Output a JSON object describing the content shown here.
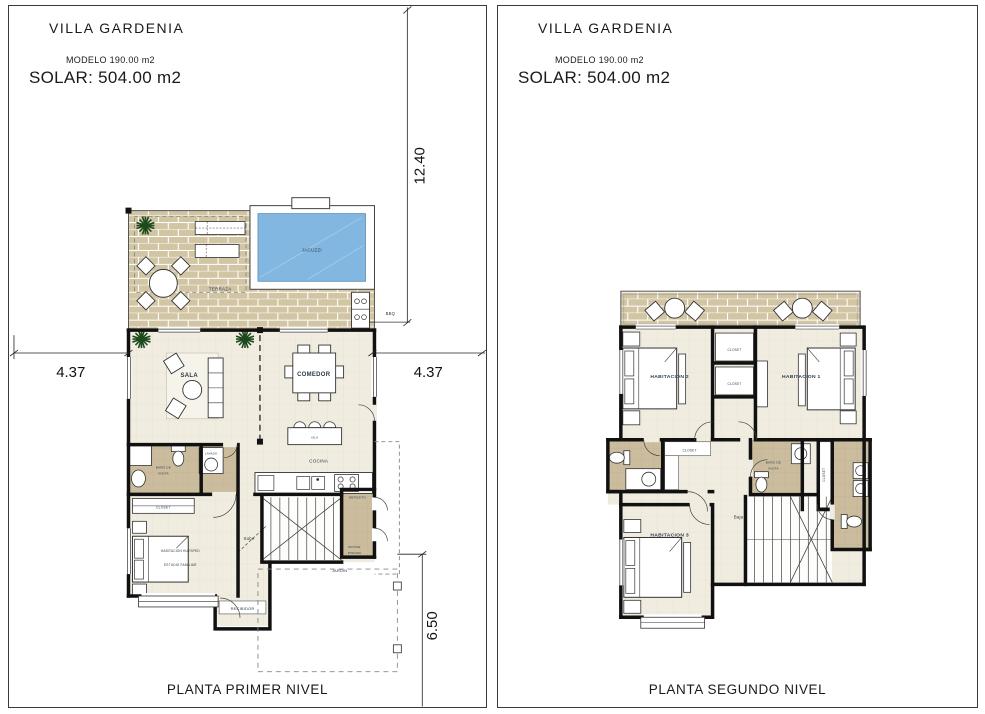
{
  "panel1": {
    "title": "VILLA GARDENIA",
    "modelo": "MODELO 190.00 m2",
    "solar": "SOLAR: 504.00 m2",
    "caption": "PLANTA PRIMER NIVEL",
    "dim_top": "12.40",
    "dim_left": "4.37",
    "dim_right": "4.37",
    "dim_bottom": "6.50",
    "labels": {
      "jacuzzi": "JACUZZI",
      "terraza": "TERRAZA",
      "bbq": "BBQ",
      "sala": "SALA",
      "comedor": "COMEDOR",
      "isla": "ISLA",
      "cocina": "COCINA",
      "bano1": "BAÑO DE",
      "bano2": "VISITA",
      "lavado": "LAVADO",
      "closet": "CLOSET",
      "habitacion1": "HABITACION HUESPED",
      "habitacion2": "ESTUDIO FAMILIAR",
      "sube": "Sube",
      "recibidor": "RECIBIDOR",
      "deposito": "DEPOSITO",
      "motor1": "MOTOR",
      "motor2": "PISCINA",
      "jardin": "JARDIN"
    }
  },
  "panel2": {
    "title": "VILLA GARDENIA",
    "modelo": "MODELO 190.00 m2",
    "solar": "SOLAR: 504.00 m2",
    "caption": "PLANTA SEGUNDO NIVEL",
    "labels": {
      "hab1": "HABITACION 1",
      "hab2": "HABITACION 2",
      "hab3": "HABITACION 3",
      "closet_a": "CLOSET",
      "closet_b": "CLOSET",
      "closet_c": "CLOSET",
      "closet_d": "CLOSET",
      "bano1": "BAÑO DE",
      "bano2": "VISITA",
      "baja": "Baja"
    }
  },
  "colors": {
    "water": "#82b7e2",
    "brick": "#d2c5a4",
    "floor": "#f0ece0",
    "bath_floor": "#cbbc9e",
    "wall": "#111111",
    "label": "#2c3a49"
  }
}
